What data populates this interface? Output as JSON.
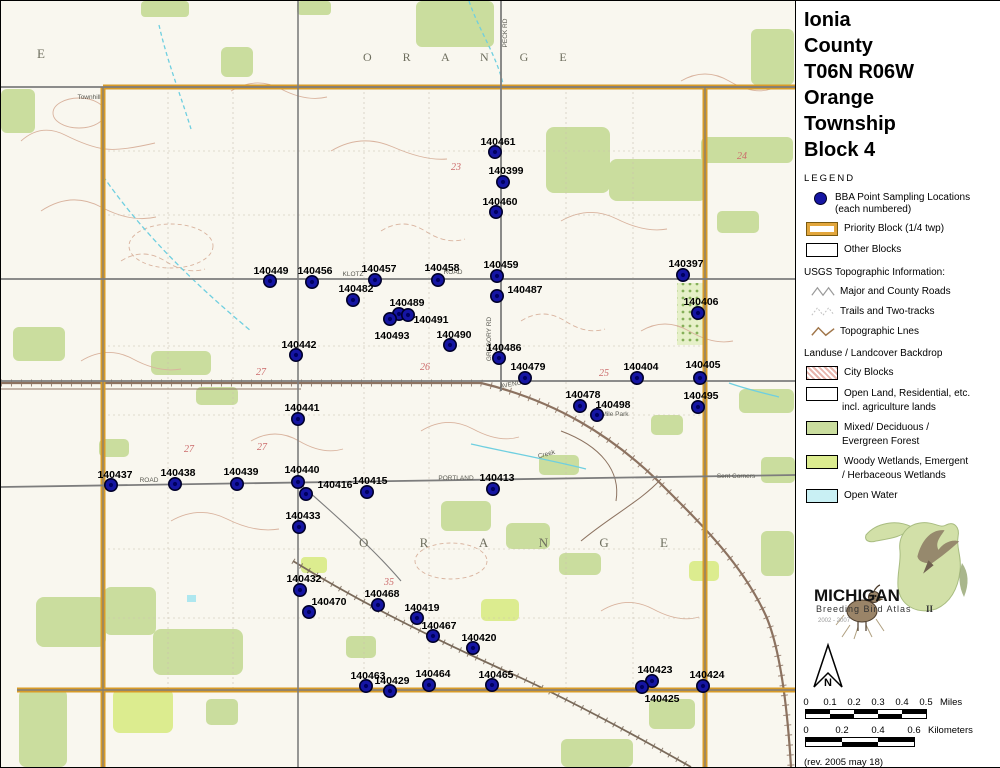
{
  "title": {
    "lines": [
      "Ionia",
      "County",
      "T06N R06W",
      "Orange",
      "Township",
      "Block 4"
    ]
  },
  "legend": {
    "heading": "LEGEND",
    "items": [
      {
        "label1": "BBA Point Sampling Locations",
        "label2": "(each numbered)"
      },
      {
        "label1": "Priority Block (1/4 twp)"
      },
      {
        "label1": "Other Blocks"
      }
    ]
  },
  "usgs": {
    "heading": "USGS Topographic Information:",
    "items": [
      {
        "label": "Major and County Roads"
      },
      {
        "label": "Trails and Two-tracks"
      },
      {
        "label": "Topographic Lnes"
      }
    ]
  },
  "landuse": {
    "heading": "Landuse / Landcover Backdrop",
    "items": [
      {
        "label": "City Blocks"
      },
      {
        "label": "Open Land, Residential, etc.",
        "label2": "incl. agriculture lands"
      },
      {
        "label": "Mixed/ Deciduous /",
        "label2": "Evergreen Forest"
      },
      {
        "label": "Woody Wetlands, Emergent",
        "label2": "/ Herbaceous Wetlands"
      },
      {
        "label": "Open Water"
      }
    ]
  },
  "logo": {
    "name": "MICHIGAN",
    "subtitle": "Breeding Bird Atlas",
    "years": "2002 - 2007",
    "numeral": "II"
  },
  "north": {
    "label": "N"
  },
  "scale": {
    "miles": {
      "ticks": [
        "0",
        "0.1",
        "0.2",
        "0.3",
        "0.4",
        "0.5"
      ],
      "unit": "Miles"
    },
    "km": {
      "ticks": [
        "0",
        "0.2",
        "0.4",
        "0.6"
      ],
      "unit": "Kilometers"
    }
  },
  "revision": "(rev. 2005 may 18)",
  "colors": {
    "priority_orange": "#d89b28",
    "dot_blue": "#1515a3",
    "forest_green": "#cadd9e",
    "wetland_green": "#dcec8f",
    "open_water": "#c9f0f4",
    "city_pink": "#e8b5ad"
  },
  "map": {
    "township_labels": [
      {
        "t": "O R A N G E",
        "x": 362,
        "y": 60,
        "size": 12,
        "ls": 14
      },
      {
        "t": "O R A N G E",
        "x": 358,
        "y": 546,
        "size": 13,
        "ls": 24
      },
      {
        "t": "E",
        "x": 36,
        "y": 57,
        "size": 13,
        "ls": 0
      }
    ],
    "section_numbers": [
      {
        "t": "23",
        "x": 455,
        "y": 169
      },
      {
        "t": "24",
        "x": 741,
        "y": 158
      },
      {
        "t": "27",
        "x": 260,
        "y": 374
      },
      {
        "t": "26",
        "x": 424,
        "y": 369
      },
      {
        "t": "25",
        "x": 603,
        "y": 375
      },
      {
        "t": "27",
        "x": 188,
        "y": 451
      },
      {
        "t": "27",
        "x": 261,
        "y": 449
      },
      {
        "t": "35",
        "x": 388,
        "y": 584
      }
    ],
    "road_labels": [
      {
        "t": "GREGORY RD",
        "x": 490,
        "y": 338,
        "r": -90
      },
      {
        "t": "KLOTZ",
        "x": 352,
        "y": 275,
        "r": 0
      },
      {
        "t": "ROAD",
        "x": 452,
        "y": 273,
        "r": 0
      },
      {
        "t": "ROAD",
        "x": 148,
        "y": 481,
        "r": 0
      },
      {
        "t": "PORTLAND",
        "x": 455,
        "y": 479,
        "r": 0
      },
      {
        "t": "AVENUE",
        "x": 512,
        "y": 385,
        "r": -10
      },
      {
        "t": "Sent Corners",
        "x": 735,
        "y": 477,
        "r": 0
      },
      {
        "t": "Mile Park",
        "x": 614,
        "y": 415,
        "r": 0
      },
      {
        "t": "Townhill",
        "x": 88,
        "y": 98,
        "r": 0
      },
      {
        "t": "Creek",
        "x": 546,
        "y": 455,
        "r": -15
      },
      {
        "t": "PECK RD",
        "x": 506,
        "y": 32,
        "r": -90
      }
    ],
    "points": [
      {
        "id": "140461",
        "x": 494,
        "y": 151,
        "lx": 497,
        "ly": 144
      },
      {
        "id": "140399",
        "x": 502,
        "y": 181,
        "lx": 505,
        "ly": 173
      },
      {
        "id": "140460",
        "x": 495,
        "y": 211,
        "lx": 499,
        "ly": 204
      },
      {
        "id": "140459",
        "x": 496,
        "y": 275,
        "lx": 500,
        "ly": 267
      },
      {
        "id": "140449",
        "x": 269,
        "y": 280,
        "lx": 270,
        "ly": 273
      },
      {
        "id": "140456",
        "x": 311,
        "y": 281,
        "lx": 314,
        "ly": 273
      },
      {
        "id": "140457",
        "x": 374,
        "y": 279,
        "lx": 378,
        "ly": 271
      },
      {
        "id": "140458",
        "x": 437,
        "y": 279,
        "lx": 441,
        "ly": 270
      },
      {
        "id": "140487",
        "x": 496,
        "y": 295,
        "lx": 524,
        "ly": 292
      },
      {
        "id": "140482",
        "x": 352,
        "y": 299,
        "lx": 355,
        "ly": 291
      },
      {
        "id": "140489",
        "x": 398,
        "y": 313,
        "lx": 406,
        "ly": 305
      },
      {
        "id": "140491",
        "x": 407,
        "y": 314,
        "lx": 430,
        "ly": 322
      },
      {
        "id": "140493",
        "x": 389,
        "y": 318,
        "lx": 391,
        "ly": 338
      },
      {
        "id": "140490",
        "x": 449,
        "y": 344,
        "lx": 453,
        "ly": 337
      },
      {
        "id": "140442",
        "x": 295,
        "y": 354,
        "lx": 298,
        "ly": 347
      },
      {
        "id": "140486",
        "x": 498,
        "y": 357,
        "lx": 503,
        "ly": 350
      },
      {
        "id": "140479",
        "x": 524,
        "y": 377,
        "lx": 527,
        "ly": 369
      },
      {
        "id": "140404",
        "x": 636,
        "y": 377,
        "lx": 640,
        "ly": 369
      },
      {
        "id": "140405",
        "x": 699,
        "y": 377,
        "lx": 702,
        "ly": 367
      },
      {
        "id": "140478",
        "x": 579,
        "y": 405,
        "lx": 582,
        "ly": 397
      },
      {
        "id": "140498",
        "x": 596,
        "y": 414,
        "lx": 612,
        "ly": 407
      },
      {
        "id": "140495",
        "x": 697,
        "y": 406,
        "lx": 700,
        "ly": 398
      },
      {
        "id": "140441",
        "x": 297,
        "y": 418,
        "lx": 301,
        "ly": 410
      },
      {
        "id": "140397",
        "x": 682,
        "y": 274,
        "lx": 685,
        "ly": 266
      },
      {
        "id": "140406",
        "x": 697,
        "y": 312,
        "lx": 700,
        "ly": 304
      },
      {
        "id": "140437",
        "x": 110,
        "y": 484,
        "lx": 114,
        "ly": 477
      },
      {
        "id": "140438",
        "x": 174,
        "y": 483,
        "lx": 177,
        "ly": 475
      },
      {
        "id": "140439",
        "x": 236,
        "y": 483,
        "lx": 240,
        "ly": 474
      },
      {
        "id": "140440",
        "x": 297,
        "y": 481,
        "lx": 301,
        "ly": 472
      },
      {
        "id": "140416",
        "x": 305,
        "y": 493,
        "lx": 334,
        "ly": 487
      },
      {
        "id": "140415",
        "x": 366,
        "y": 491,
        "lx": 369,
        "ly": 483
      },
      {
        "id": "140413",
        "x": 492,
        "y": 488,
        "lx": 496,
        "ly": 480
      },
      {
        "id": "140433",
        "x": 298,
        "y": 526,
        "lx": 302,
        "ly": 518
      },
      {
        "id": "140432",
        "x": 299,
        "y": 589,
        "lx": 303,
        "ly": 581
      },
      {
        "id": "140470",
        "x": 308,
        "y": 611,
        "lx": 328,
        "ly": 604
      },
      {
        "id": "140468",
        "x": 377,
        "y": 604,
        "lx": 381,
        "ly": 596
      },
      {
        "id": "140419",
        "x": 416,
        "y": 617,
        "lx": 421,
        "ly": 610
      },
      {
        "id": "140467",
        "x": 432,
        "y": 635,
        "lx": 438,
        "ly": 628
      },
      {
        "id": "140420",
        "x": 472,
        "y": 647,
        "lx": 478,
        "ly": 640
      },
      {
        "id": "140463",
        "x": 365,
        "y": 685,
        "lx": 367,
        "ly": 678
      },
      {
        "id": "140429",
        "x": 389,
        "y": 690,
        "lx": 391,
        "ly": 683
      },
      {
        "id": "140464",
        "x": 428,
        "y": 684,
        "lx": 432,
        "ly": 676
      },
      {
        "id": "140465",
        "x": 491,
        "y": 684,
        "lx": 495,
        "ly": 677
      },
      {
        "id": "140423",
        "x": 651,
        "y": 680,
        "lx": 654,
        "ly": 672
      },
      {
        "id": "140425",
        "x": 641,
        "y": 686,
        "lx": 661,
        "ly": 701
      },
      {
        "id": "140424",
        "x": 702,
        "y": 685,
        "lx": 706,
        "ly": 677
      }
    ]
  }
}
